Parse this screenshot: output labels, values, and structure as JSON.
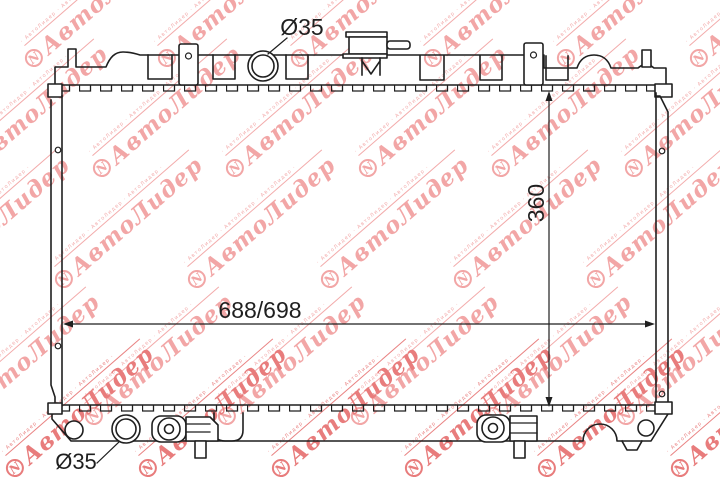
{
  "dimensions": {
    "top_port_diameter": "Ø35",
    "bottom_port_diameter": "Ø35",
    "core_height": "360",
    "overall_width": "688/698"
  },
  "watermark": {
    "brand": "АвтоЛидер",
    "logo_letter": "N",
    "tagline": "· АвтоЛидер · АвтоЛидер · АвтоЛидер ·",
    "color_light": "#f2a6a6",
    "color_bright": "#e87c7c"
  },
  "drawing": {
    "ink": "#1f1f1f",
    "background": "#ffffff"
  }
}
